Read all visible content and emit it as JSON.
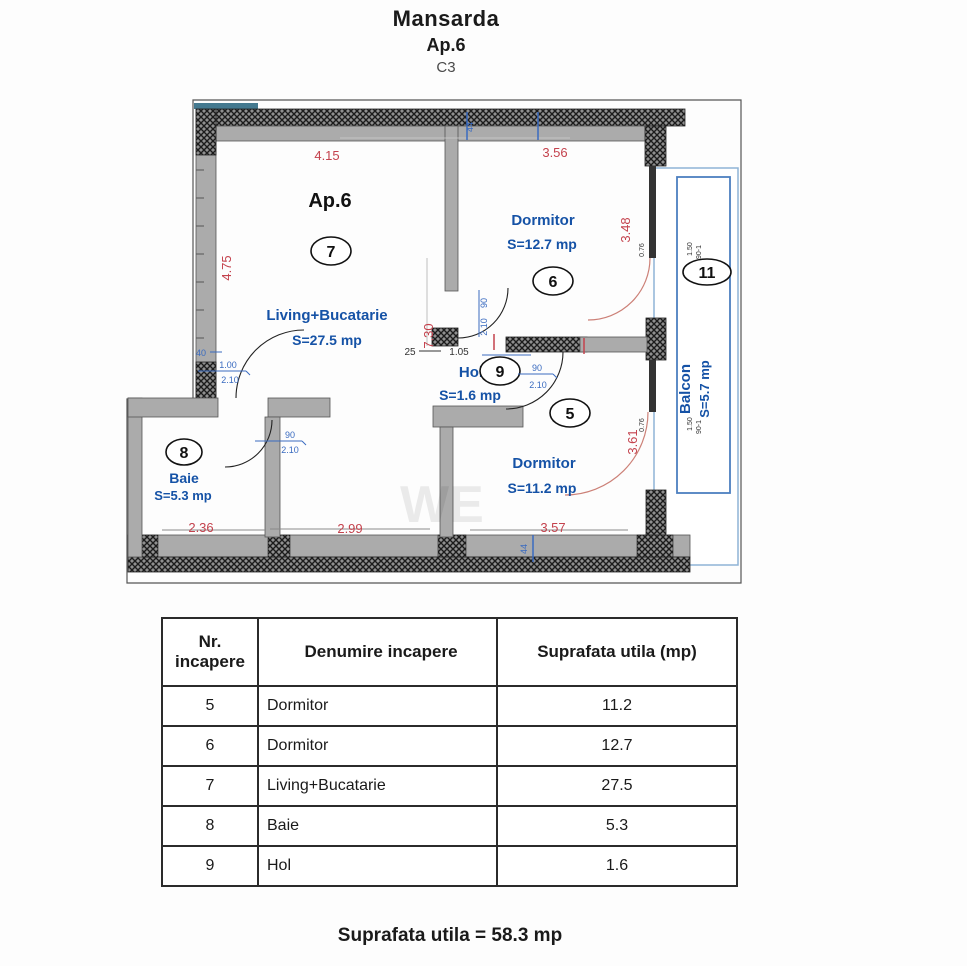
{
  "title": {
    "building": "Mansarda",
    "apartment": "Ap.6",
    "block": "C3"
  },
  "plan": {
    "apartment_label": "Ap.6",
    "watermark": "WE",
    "rooms": {
      "living": {
        "num": "7",
        "name": "Living+Bucatarie",
        "area": "S=27.5 mp"
      },
      "dorm6": {
        "num": "6",
        "name": "Dormitor",
        "area": "S=12.7 mp"
      },
      "dorm5": {
        "num": "5",
        "name": "Dormitor",
        "area": "S=11.2 mp"
      },
      "baie": {
        "num": "8",
        "name": "Baie",
        "area": "S=5.3 mp"
      },
      "hol": {
        "num": "9",
        "name": "Hol",
        "area": "S=1.6 mp"
      },
      "balcon": {
        "num": "11",
        "name": "Balcon",
        "area": "S=5.7 mp"
      }
    },
    "dims": {
      "living_top": "4.15",
      "dorm6_top": "3.56",
      "living_left": "4.75",
      "dorm6_right": "3.48",
      "mid_vertical": "7.30",
      "dorm5_right": "3.61",
      "baie_bottom": "2.36",
      "living_bottom": "2.99",
      "dorm5_bottom": "3.57"
    },
    "door_labels": {
      "w40": "40",
      "w90": "90",
      "h210": "2.10",
      "w100": "1.00",
      "hol_a": "25",
      "hol_b": "1.05",
      "t44": "44"
    },
    "window_labels": {
      "a": "0.76",
      "b": "1.50",
      "c": "90-1"
    }
  },
  "table": {
    "headers": {
      "col1": "Nr.",
      "col1b": "incapere",
      "col2": "Denumire incapere",
      "col3": "Suprafata utila (mp)"
    },
    "rows": [
      {
        "nr": "5",
        "name": "Dormitor",
        "area": "11.2"
      },
      {
        "nr": "6",
        "name": "Dormitor",
        "area": "12.7"
      },
      {
        "nr": "7",
        "name": "Living+Bucatarie",
        "area": "27.5"
      },
      {
        "nr": "8",
        "name": "Baie",
        "area": "5.3"
      },
      {
        "nr": "9",
        "name": "Hol",
        "area": "1.6"
      }
    ]
  },
  "total": "Suprafata utila = 58.3 mp",
  "colors": {
    "label_blue": "#1552a6",
    "dim_red": "#c4424d",
    "balcony_blue": "#4d7fc0"
  }
}
